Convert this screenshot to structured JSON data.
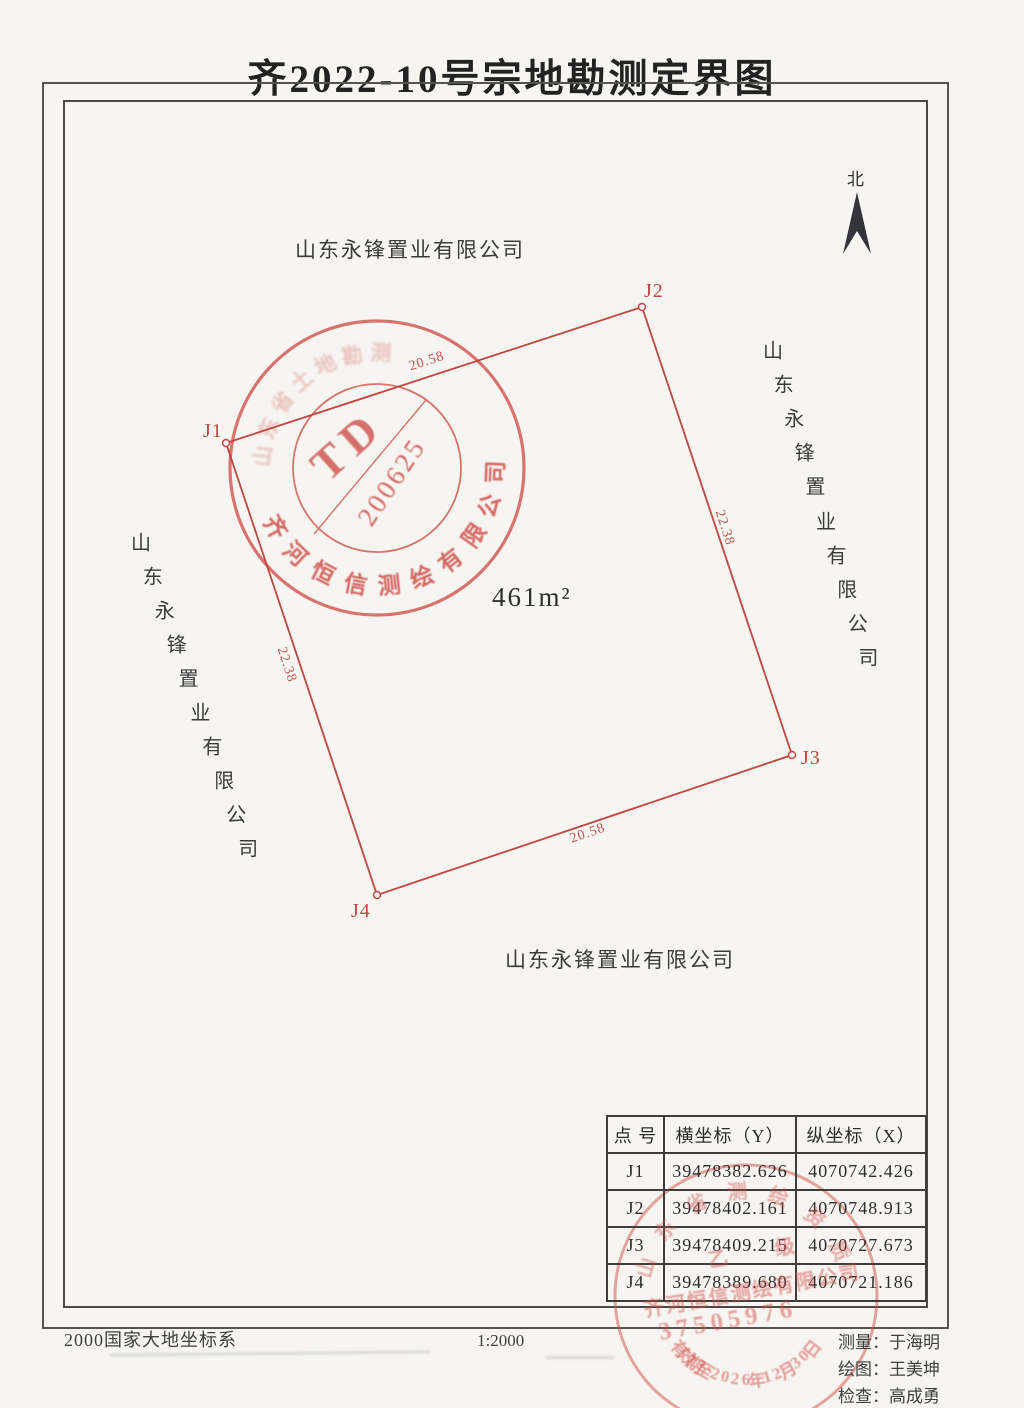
{
  "title": "齐2022-10号宗地勘测定界图",
  "north_label": "北",
  "area_label": "461m²",
  "parcel": {
    "vertices": [
      {
        "label": "J1"
      },
      {
        "label": "J2"
      },
      {
        "label": "J3"
      },
      {
        "label": "J4"
      }
    ],
    "edge_lengths": {
      "top": "20.58",
      "right": "22.38",
      "bottom": "20.58",
      "left": "22.38"
    }
  },
  "adjacent_owners": {
    "top": "山东永锋置业有限公司",
    "bottom": "山东永锋置业有限公司",
    "left": "山东永锋置业有限公司",
    "right": "山东永锋置业有限公司"
  },
  "survey_stamp": {
    "code": "TD",
    "number": "200625",
    "ring_bottom": "齐河恒信测绘有限公司",
    "ring_top_faint": "山东省土地勘测"
  },
  "cert_stamp": {
    "arc_top": "山东省测绘资质",
    "grade": "乙　级",
    "company": "齐河恒信测绘有限公司",
    "number": "37505976",
    "arc_bottom": "有效期至2026年12月30日"
  },
  "table": {
    "headers": [
      "点 号",
      "横坐标（Y）",
      "纵坐标（X）"
    ],
    "rows": [
      [
        "J1",
        "39478382.626",
        "4070742.426"
      ],
      [
        "J2",
        "39478402.161",
        "4070748.913"
      ],
      [
        "J3",
        "39478409.215",
        "4070727.673"
      ],
      [
        "J4",
        "39478389.680",
        "4070721.186"
      ]
    ]
  },
  "footer": {
    "datum": "2000国家大地坐标系",
    "scale": "1:2000",
    "credits": [
      "测量：于海明",
      "绘图：王美坤",
      "检查：高成勇"
    ]
  }
}
